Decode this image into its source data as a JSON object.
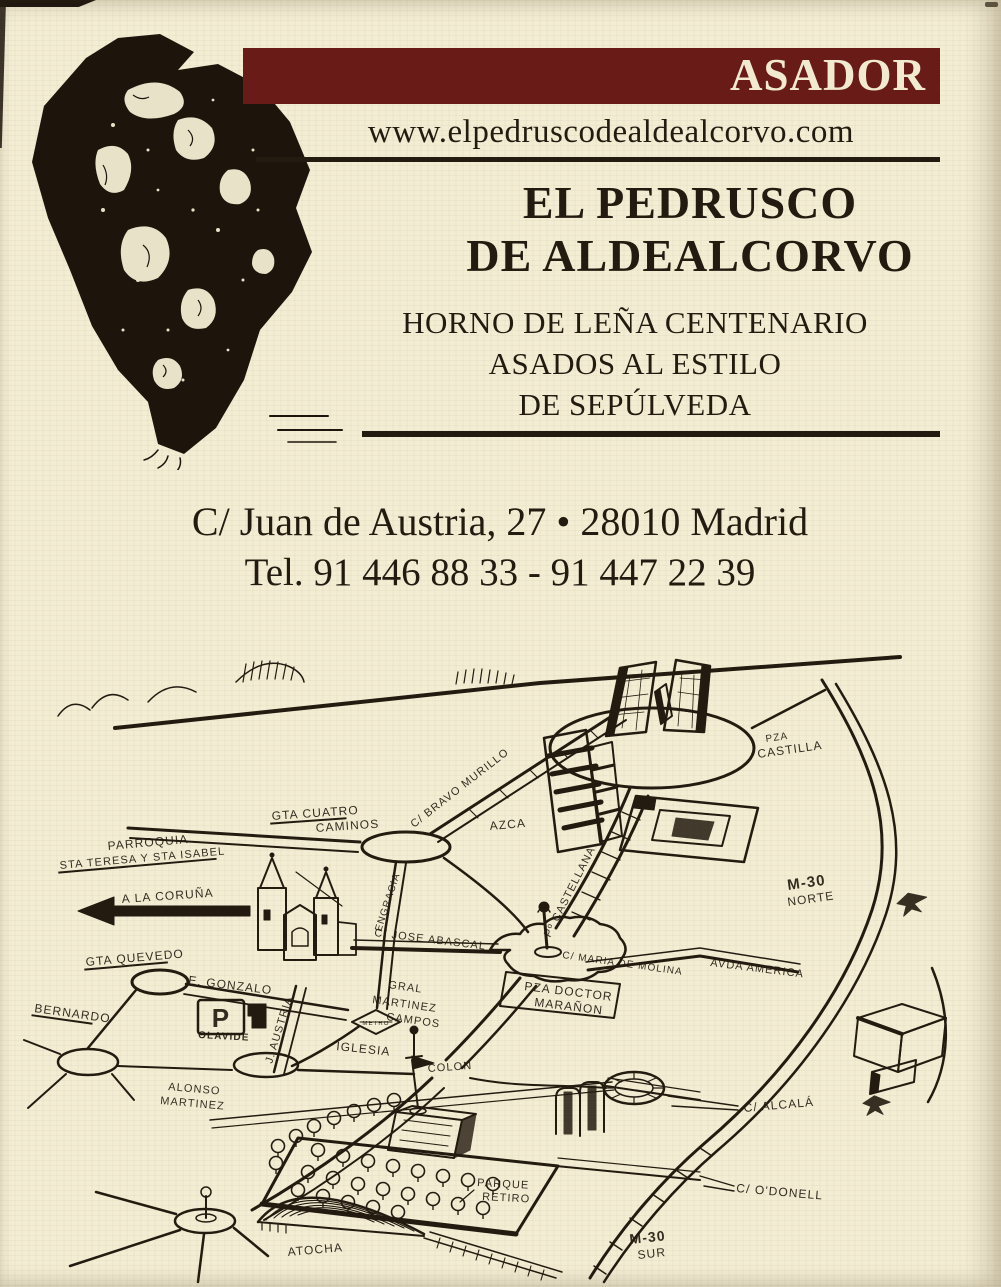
{
  "card": {
    "banner_label": "ASADOR",
    "website": "www.elpedruscodealdealcorvo.com",
    "title_line1": "EL PEDRUSCO",
    "title_line2": "DE ALDEALCORVO",
    "tagline_line1": "HORNO DE LEÑA CENTENARIO",
    "tagline_line2": "ASADOS AL ESTILO",
    "tagline_line3": "DE SEPÚLVEDA",
    "address": "C/ Juan de Austria, 27 • 28010 Madrid",
    "phone": "Tel. 91 446 88 33 - 91 447 22 39"
  },
  "colors": {
    "banner_bg": "#681b17",
    "paper": "#f3edd4",
    "ink": "#241b10"
  },
  "map": {
    "parking_badge": "P",
    "metro_badge": "METRO",
    "labels": [
      {
        "id": "gta-cuatro-caminos-1",
        "t": "GTA CUATRO",
        "x": 272,
        "y": 200,
        "r": -4,
        "s": 12,
        "u": 1
      },
      {
        "id": "gta-cuatro-caminos-2",
        "t": "CAMINOS",
        "x": 316,
        "y": 212,
        "r": -4,
        "s": 12
      },
      {
        "id": "c-bravo-murillo",
        "t": "C/ BRAVO MURILLO",
        "x": 414,
        "y": 208,
        "r": -38,
        "s": 11
      },
      {
        "id": "azca",
        "t": "AZCA",
        "x": 490,
        "y": 210,
        "r": -5,
        "s": 12
      },
      {
        "id": "pza-castilla-1",
        "t": "PZA",
        "x": 766,
        "y": 122,
        "r": -8,
        "s": 10
      },
      {
        "id": "pza-castilla-2",
        "t": "CASTILLA",
        "x": 758,
        "y": 138,
        "r": -8,
        "s": 12
      },
      {
        "id": "m30-norte-1",
        "t": "M-30",
        "x": 788,
        "y": 270,
        "r": -8,
        "s": 15,
        "w": 1
      },
      {
        "id": "m30-norte-2",
        "t": "NORTE",
        "x": 788,
        "y": 286,
        "r": -8,
        "s": 12
      },
      {
        "id": "parroquia-1",
        "t": "PARROQUIA",
        "x": 108,
        "y": 230,
        "r": -5,
        "s": 12
      },
      {
        "id": "parroquia-2",
        "t": "STA TERESA Y STA ISABEL",
        "x": 60,
        "y": 249,
        "r": -5,
        "s": 11,
        "u": 1
      },
      {
        "id": "a-la-coruna",
        "t": "A LA CORUÑA",
        "x": 122,
        "y": 283,
        "r": -4,
        "s": 12
      },
      {
        "id": "gta-quevedo",
        "t": "GTA QUEVEDO",
        "x": 86,
        "y": 346,
        "r": -5,
        "s": 12,
        "u": 1
      },
      {
        "id": "e-gonzalo",
        "t": "E. GONZALO",
        "x": 188,
        "y": 364,
        "r": 7,
        "s": 12
      },
      {
        "id": "bernardo",
        "t": "BERNARDO",
        "x": 34,
        "y": 392,
        "r": 8,
        "s": 12,
        "u": 1
      },
      {
        "id": "olavide",
        "t": "OLAVIDE",
        "x": 198,
        "y": 418,
        "r": 3,
        "s": 10,
        "w": 1
      },
      {
        "id": "j-austria",
        "t": "J. AUSTRIA",
        "x": 272,
        "y": 444,
        "r": -73,
        "s": 11
      },
      {
        "id": "engracia",
        "t": "ENGRACIA",
        "x": 381,
        "y": 312,
        "r": -72,
        "s": 10
      },
      {
        "id": "c-jose-abascal",
        "t": "C/ JOSE ABASCAL",
        "x": 374,
        "y": 316,
        "r": 7,
        "s": 11
      },
      {
        "id": "iglesia",
        "t": "IGLESIA",
        "x": 336,
        "y": 430,
        "r": 6,
        "s": 12
      },
      {
        "id": "gral",
        "t": "GRAL",
        "x": 388,
        "y": 368,
        "r": 8,
        "s": 11
      },
      {
        "id": "martinez-campos-1",
        "t": "MARTINEZ",
        "x": 372,
        "y": 383,
        "r": 8,
        "s": 11
      },
      {
        "id": "martinez-campos-2",
        "t": "CAMPOS",
        "x": 386,
        "y": 400,
        "r": 8,
        "s": 11
      },
      {
        "id": "pza-doctor-maranon-1",
        "t": "PZA DOCTOR",
        "x": 524,
        "y": 370,
        "r": 7,
        "s": 12
      },
      {
        "id": "pza-doctor-maranon-2",
        "t": "MARAÑON",
        "x": 534,
        "y": 386,
        "r": 7,
        "s": 12
      },
      {
        "id": "c-maria-de-molina",
        "t": "C/ MARIA DE MOLINA",
        "x": 562,
        "y": 338,
        "r": 8,
        "s": 10
      },
      {
        "id": "avda-america",
        "t": "AVDA AMERICA",
        "x": 710,
        "y": 346,
        "r": 7,
        "s": 11
      },
      {
        "id": "po-castellana",
        "t": "Pº CASTELLANA",
        "x": 550,
        "y": 318,
        "r": -63,
        "s": 11
      },
      {
        "id": "colon",
        "t": "COLON",
        "x": 428,
        "y": 452,
        "r": -4,
        "s": 11
      },
      {
        "id": "alonso-martinez-1",
        "t": "ALONSO",
        "x": 168,
        "y": 470,
        "r": 5,
        "s": 11
      },
      {
        "id": "alonso-martinez-2",
        "t": "MARTINEZ",
        "x": 160,
        "y": 484,
        "r": 5,
        "s": 11
      },
      {
        "id": "c-alcala",
        "t": "C/ ALCALÁ",
        "x": 744,
        "y": 492,
        "r": -5,
        "s": 12
      },
      {
        "id": "c-odonell",
        "t": "C/ O'DONELL",
        "x": 736,
        "y": 572,
        "r": 5,
        "s": 12
      },
      {
        "id": "parque-retiro-1",
        "t": "PARQUE",
        "x": 477,
        "y": 566,
        "r": 3,
        "s": 11
      },
      {
        "id": "parque-retiro-2",
        "t": "RETIRO",
        "x": 482,
        "y": 580,
        "r": 3,
        "s": 11
      },
      {
        "id": "m30-sur-1",
        "t": "M-30",
        "x": 630,
        "y": 624,
        "r": -6,
        "s": 14,
        "w": 1
      },
      {
        "id": "m30-sur-2",
        "t": "SUR",
        "x": 638,
        "y": 639,
        "r": -6,
        "s": 12
      },
      {
        "id": "atocha",
        "t": "ATOCHA",
        "x": 288,
        "y": 636,
        "r": -5,
        "s": 12
      }
    ]
  }
}
